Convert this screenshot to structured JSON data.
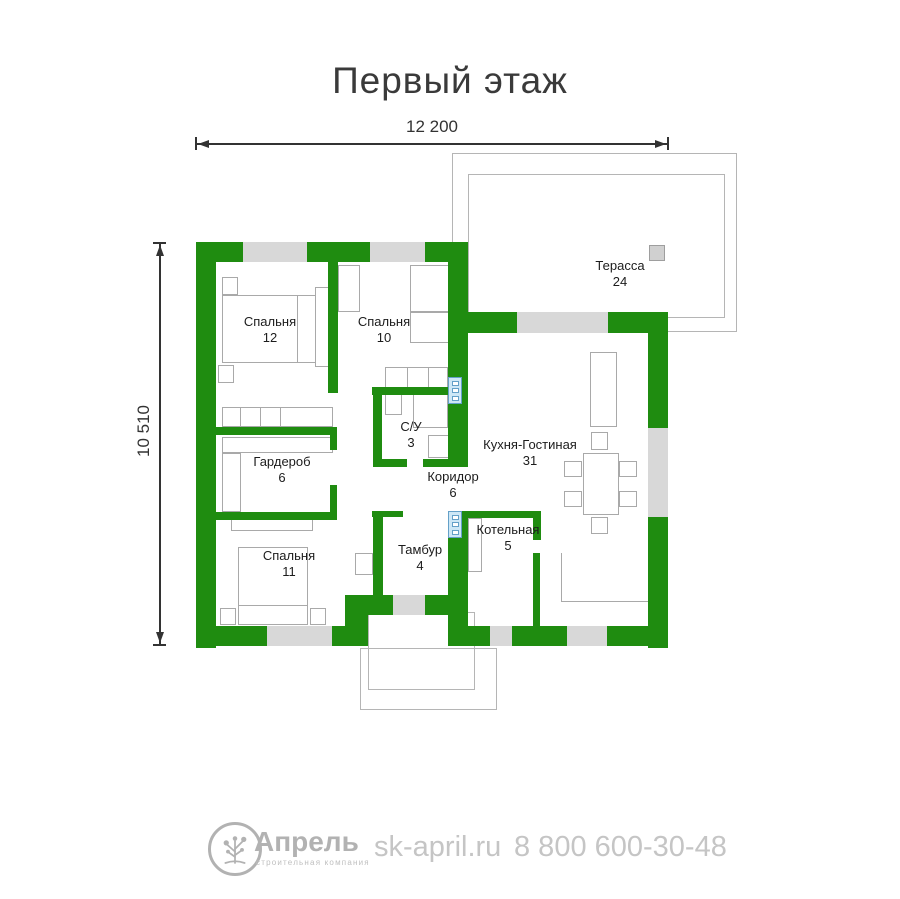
{
  "title": "Первый этаж",
  "dimensions": {
    "width": "12 200",
    "height": "10 510"
  },
  "rooms": [
    {
      "name": "Спальня",
      "area": "12"
    },
    {
      "name": "Спальня",
      "area": "10"
    },
    {
      "name": "Терасса",
      "area": "24"
    },
    {
      "name": "Гардероб",
      "area": "6"
    },
    {
      "name": "С/У",
      "area": "3"
    },
    {
      "name": "Кухня-Гостиная",
      "area": "31"
    },
    {
      "name": "Коридор",
      "area": "6"
    },
    {
      "name": "Спальня",
      "area": "11"
    },
    {
      "name": "Тамбур",
      "area": "4"
    },
    {
      "name": "Котельная",
      "area": "5"
    }
  ],
  "footer": {
    "brand": "Апрель",
    "tagline": "строительная компания",
    "website": "sk-april.ru",
    "phone": "8 800 600-30-48"
  },
  "colors": {
    "wall": "#1f8c10",
    "window": "#d8d8d8",
    "shaft_fill": "#cde7f6",
    "shaft_border": "#64a0c8"
  }
}
